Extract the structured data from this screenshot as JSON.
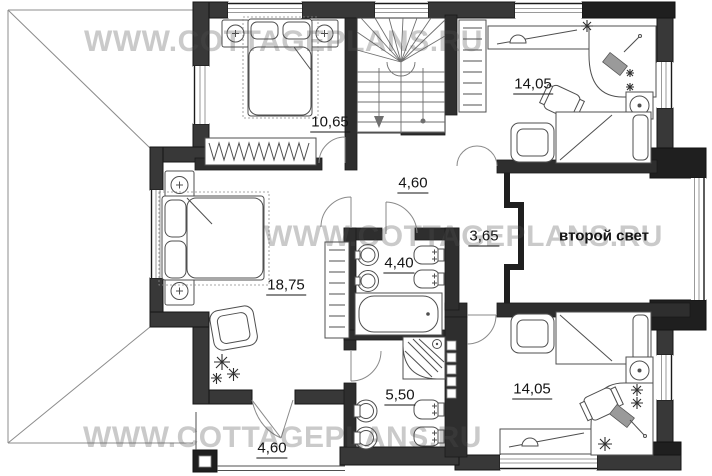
{
  "watermark": {
    "text": "WWW.COTTAGEPLANS.RU"
  },
  "plan": {
    "labels": {
      "bedroom_top": "10,65",
      "bedroom_top_right": "14,05",
      "hallway": "4,60",
      "corridor": "3,65",
      "bathroom": "4,40",
      "master_bedroom": "18,75",
      "shower_room": "5,50",
      "bedroom_bottom_right": "14,05",
      "balcony": "4,60",
      "double_height": "второй свет"
    },
    "colors": {
      "exterior_wall": "#383838",
      "corner_wall": "#1f1f1f",
      "interior_wall": "#2e2e2e",
      "furniture_line": "#4f4f4f",
      "watermark": "rgba(80,80,80,0.30)"
    }
  }
}
